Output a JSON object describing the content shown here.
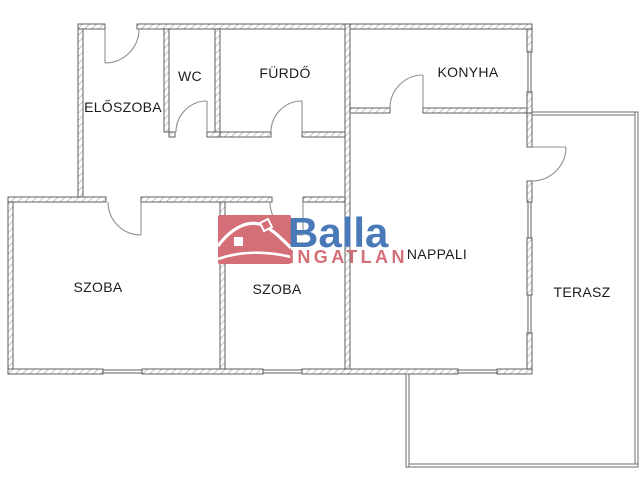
{
  "page": {
    "background": "#ffffff",
    "width": 640,
    "height": 480
  },
  "colors": {
    "wall_outline": "#4f4f4f",
    "wall_hatch": "#9f9f9f",
    "thin_wall_outline": "#6e6e6e",
    "door_stroke": "#8f8f8f",
    "label_text": "#1c1c1c",
    "logo_blue": "#4a79b8",
    "logo_red": "#d46e77"
  },
  "rooms": [
    {
      "id": "eloszoba",
      "label": "ELŐSZOBA",
      "cx": 123,
      "cy": 107
    },
    {
      "id": "wc",
      "label": "WC",
      "cx": 190,
      "cy": 76
    },
    {
      "id": "furdo",
      "label": "FÜRDŐ",
      "cx": 285,
      "cy": 73
    },
    {
      "id": "konyha",
      "label": "KONYHA",
      "cx": 468,
      "cy": 72
    },
    {
      "id": "nappali",
      "label": "NAPPALI",
      "cx": 437,
      "cy": 254
    },
    {
      "id": "szoba-1",
      "label": "SZOBA",
      "cx": 98,
      "cy": 287
    },
    {
      "id": "szoba-2",
      "label": "SZOBA",
      "cx": 277,
      "cy": 289
    },
    {
      "id": "terasz",
      "label": "TERASZ",
      "cx": 582,
      "cy": 292
    }
  ],
  "walls": [
    [
      78,
      24,
      27,
      5
    ],
    [
      137,
      24,
      395,
      5
    ],
    [
      78,
      29,
      5,
      173
    ],
    [
      164,
      29,
      5,
      103
    ],
    [
      215,
      29,
      5,
      103
    ],
    [
      169,
      132,
      6,
      5
    ],
    [
      207,
      132,
      13,
      5
    ],
    [
      220,
      132,
      51,
      5
    ],
    [
      302,
      132,
      43,
      5
    ],
    [
      345,
      24,
      5,
      350
    ],
    [
      350,
      108,
      40,
      5
    ],
    [
      423,
      108,
      109,
      5
    ],
    [
      527,
      29,
      5,
      23
    ],
    [
      527,
      92,
      5,
      21
    ],
    [
      8,
      197,
      98,
      5
    ],
    [
      141,
      197,
      131,
      5
    ],
    [
      303,
      197,
      42,
      5
    ],
    [
      8,
      202,
      5,
      172
    ],
    [
      8,
      369,
      95,
      5
    ],
    [
      142,
      369,
      121,
      5
    ],
    [
      302,
      369,
      156,
      5
    ],
    [
      497,
      369,
      35,
      5
    ],
    [
      220,
      202,
      5,
      167
    ],
    [
      527,
      113,
      5,
      34
    ],
    [
      527,
      181,
      5,
      21
    ],
    [
      527,
      238,
      5,
      57
    ],
    [
      527,
      333,
      5,
      36
    ]
  ],
  "thin_walls": [
    [
      532,
      112,
      106,
      3
    ],
    [
      635,
      112,
      3,
      355
    ],
    [
      406,
      464,
      232,
      3
    ],
    [
      406,
      374,
      3,
      93
    ]
  ],
  "windows": [
    {
      "rect": [
        527,
        52,
        5,
        40
      ],
      "dir": "v"
    },
    {
      "rect": [
        103,
        369,
        39,
        5
      ],
      "dir": "h"
    },
    {
      "rect": [
        263,
        369,
        39,
        5
      ],
      "dir": "h"
    },
    {
      "rect": [
        458,
        369,
        39,
        5
      ],
      "dir": "h"
    },
    {
      "rect": [
        527,
        202,
        5,
        36
      ],
      "dir": "v"
    },
    {
      "rect": [
        527,
        295,
        5,
        38
      ],
      "dir": "v"
    }
  ],
  "doors": [
    {
      "id": "entrance-door",
      "hinge": [
        105,
        29
      ],
      "tip": [
        105,
        63
      ],
      "end": [
        139,
        29
      ],
      "r": 34,
      "sweep": 0
    },
    {
      "id": "wc-door",
      "hinge": [
        207,
        132
      ],
      "tip": [
        207,
        101
      ],
      "end": [
        176,
        132
      ],
      "r": 31,
      "sweep": 0
    },
    {
      "id": "furdo-door",
      "hinge": [
        302,
        132
      ],
      "tip": [
        302,
        101
      ],
      "end": [
        271,
        132
      ],
      "r": 31,
      "sweep": 0
    },
    {
      "id": "konyha-door",
      "hinge": [
        423,
        108
      ],
      "tip": [
        423,
        75
      ],
      "end": [
        390,
        108
      ],
      "r": 33,
      "sweep": 0
    },
    {
      "id": "szoba-1-door",
      "hinge": [
        141,
        202
      ],
      "tip": [
        141,
        235
      ],
      "end": [
        108,
        202
      ],
      "r": 33,
      "sweep": 1
    },
    {
      "id": "szoba-2-door",
      "hinge": [
        303,
        202
      ],
      "tip": [
        303,
        235
      ],
      "end": [
        270,
        202
      ],
      "r": 33,
      "sweep": 1
    },
    {
      "id": "terasz-door",
      "hinge": [
        532,
        147
      ],
      "tip": [
        566,
        147
      ],
      "end": [
        532,
        181
      ],
      "r": 34,
      "sweep": 1
    }
  ],
  "labels_style": {
    "font_size": 14
  },
  "logo": {
    "brand": "Balla",
    "sub": "INGATLAN",
    "icon": "house-icon",
    "icon_x": 218,
    "icon_y": 215,
    "icon_w": 73,
    "icon_h": 49,
    "brand_x": 288,
    "brand_baseline": 247,
    "sub_x": 289,
    "sub_baseline": 263
  }
}
